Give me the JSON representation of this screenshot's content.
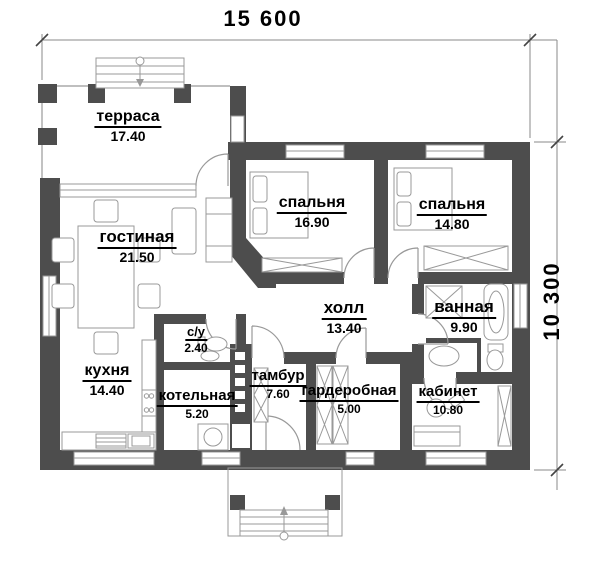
{
  "dimensions": {
    "width_label": "15 600",
    "height_label": "10 300"
  },
  "colors": {
    "wall": "#4d4d4d",
    "thin_line": "#999999",
    "text": "#000000",
    "window_fill": "#ffffff"
  },
  "rooms": [
    {
      "id": "terrace",
      "name": "терраса",
      "area": "17.40"
    },
    {
      "id": "living",
      "name": "гостиная",
      "area": "21.50"
    },
    {
      "id": "bedroom1",
      "name": "спальня",
      "area": "16.90"
    },
    {
      "id": "bedroom2",
      "name": "спальня",
      "area": "14.80"
    },
    {
      "id": "hall",
      "name": "холл",
      "area": "13.40"
    },
    {
      "id": "bathroom",
      "name": "ванная",
      "area": "9.90"
    },
    {
      "id": "wc",
      "name": "с/у",
      "area": "2.40"
    },
    {
      "id": "kitchen",
      "name": "кухня",
      "area": "14.40"
    },
    {
      "id": "boiler",
      "name": "котельная",
      "area": "5.20"
    },
    {
      "id": "vestibule",
      "name": "тамбур",
      "area": "7.60"
    },
    {
      "id": "wardrobe",
      "name": "гардеробная",
      "area": "5.00"
    },
    {
      "id": "office",
      "name": "кабинет",
      "area": "10.80"
    }
  ]
}
